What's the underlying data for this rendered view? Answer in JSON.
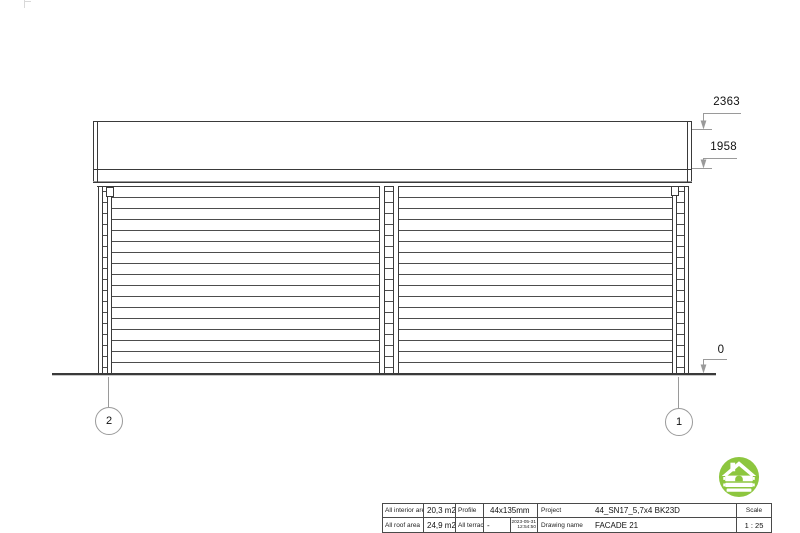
{
  "colors": {
    "accent_green": "#8dc63f",
    "line": "#3a3a3a",
    "dim_line": "#9a9a9a"
  },
  "drawing": {
    "dimensions": {
      "roof_top": "2363",
      "eave": "1958",
      "ground": "0"
    },
    "axes": {
      "left": "2",
      "right": "1"
    }
  },
  "title_block": {
    "interior_area_label": "All interior area",
    "interior_area_value": "20,3 m2",
    "roof_area_label": "All roof area",
    "roof_area_value": "24,9 m2",
    "profile_label": "Profile",
    "profile_value": "44x135mm",
    "terrace_label": "All terrace",
    "terrace_value": "-",
    "date": "2023-05-31",
    "time": "12:54:50",
    "project_label": "Project",
    "project_value": "44_SN17_5,7x4 BK23D",
    "drawing_name_label": "Drawing name",
    "drawing_name_value": "FACADE 21",
    "scale_label": "Scale",
    "scale_value": "1 : 25"
  },
  "logo": {
    "icon": "log-cabin-house-icon",
    "background": "#8dc63f"
  }
}
